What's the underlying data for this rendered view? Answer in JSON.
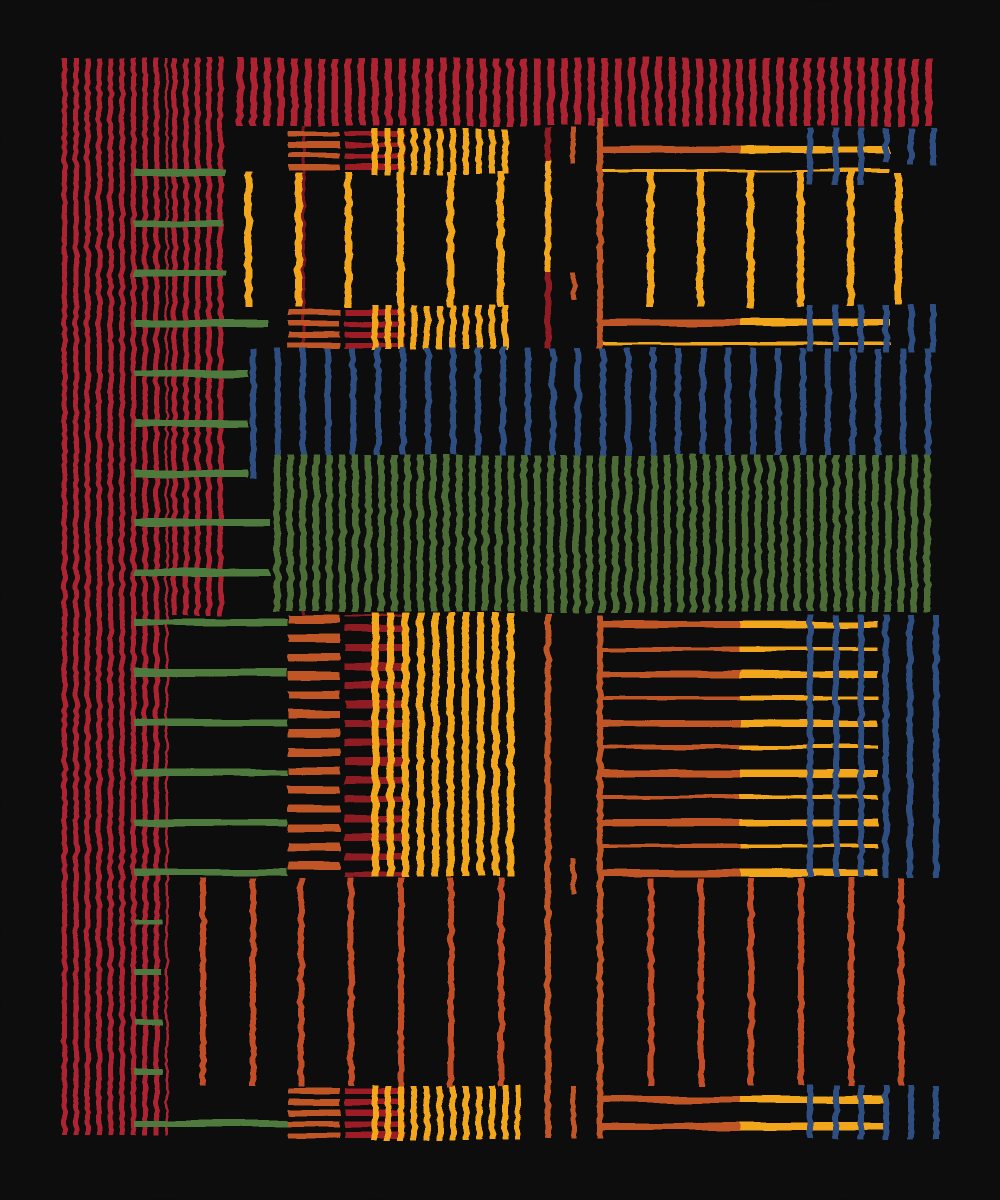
{
  "canvas": {
    "w": 1000,
    "h": 1200,
    "bg": "#0d0b08"
  },
  "palette": {
    "bg": "#0d0b08",
    "red": "#ae2130",
    "darkred": "#8e1b24",
    "darkred2": "#9e1c27",
    "orange": "#c05428",
    "rust": "#c24e26",
    "yellow": "#f2a61b",
    "green": "#4c6c36",
    "green2": "#4f7a3e",
    "blue": "#2d4e80",
    "redline": "#7a1620"
  },
  "blocks": [
    {
      "n": "left-red-column-main",
      "t": "v",
      "x": 62,
      "y": 58,
      "w": 106,
      "h": 1077,
      "c": "red",
      "p": 11.5,
      "s": 5
    },
    {
      "n": "left-red-column-secondary",
      "t": "v",
      "x": 172,
      "y": 58,
      "w": 57,
      "h": 557,
      "c": "red",
      "p": 11.5,
      "s": 5
    },
    {
      "n": "top-red-band",
      "t": "v",
      "x": 237,
      "y": 58,
      "w": 698,
      "h": 68,
      "c": "red",
      "p": 13.5,
      "s": 6.5
    },
    {
      "n": "thin-red-connector",
      "t": "r",
      "x": 302,
      "y": 126,
      "w": 3,
      "h": 489,
      "c": "redline"
    },
    {
      "n": "band1-orange-hstripes",
      "t": "h",
      "x": 288,
      "y": 131,
      "w": 52,
      "h": 41,
      "c": "orange",
      "p": 11,
      "s": 5.5
    },
    {
      "n": "band1-red-hstripes",
      "t": "h",
      "x": 345,
      "y": 131,
      "w": 60,
      "h": 41,
      "c": "darkred2",
      "p": 11,
      "s": 5.5
    },
    {
      "n": "band1-yellow-vstripes",
      "t": "v",
      "x": 372,
      "y": 128,
      "w": 143,
      "h": 47,
      "c": "yellow",
      "p": 13,
      "s": 6
    },
    {
      "n": "band2-orange-hstripes",
      "t": "h",
      "x": 288,
      "y": 310,
      "w": 52,
      "h": 38,
      "c": "orange",
      "p": 11,
      "s": 5.5
    },
    {
      "n": "band2-red-hstripes",
      "t": "h",
      "x": 345,
      "y": 310,
      "w": 60,
      "h": 38,
      "c": "darkred2",
      "p": 11,
      "s": 5.5
    },
    {
      "n": "band2-yellow-vstripes",
      "t": "v",
      "x": 372,
      "y": 305,
      "w": 143,
      "h": 45,
      "c": "yellow",
      "p": 13,
      "s": 6
    },
    {
      "n": "blue-stripe-band",
      "t": "v",
      "x": 250,
      "y": 348,
      "w": 682,
      "h": 107,
      "c": "blue",
      "p": 25,
      "s": 6
    },
    {
      "n": "blue-band-first-line",
      "t": "r",
      "x": 250,
      "y": 348,
      "w": 6,
      "h": 130,
      "c": "blue"
    },
    {
      "n": "green-stripe-block",
      "t": "v",
      "x": 274,
      "y": 455,
      "w": 659,
      "h": 157,
      "c": "green",
      "p": 13,
      "s": 6.5
    },
    {
      "n": "midleft-orange-hstripes",
      "t": "h",
      "x": 288,
      "y": 615,
      "w": 52,
      "h": 262,
      "c": "orange",
      "p": 19,
      "s": 8
    },
    {
      "n": "midleft-red-hstripes",
      "t": "h",
      "x": 345,
      "y": 615,
      "w": 27,
      "h": 262,
      "c": "darkred",
      "p": 19,
      "s": 7,
      "o": 10
    },
    {
      "n": "midleft-plaid-red-hstripes",
      "t": "h",
      "x": 372,
      "y": 615,
      "w": 33,
      "h": 262,
      "c": "darkred",
      "p": 19,
      "s": 7,
      "o": 10
    },
    {
      "n": "midleft-yellow-vstripes",
      "t": "v",
      "x": 372,
      "y": 613,
      "w": 148,
      "h": 264,
      "c": "yellow",
      "p": 15,
      "s": 7
    },
    {
      "n": "bottomband-orange-hstripes",
      "t": "h",
      "x": 288,
      "y": 1088,
      "w": 52,
      "h": 50,
      "c": "orange",
      "p": 11,
      "s": 6
    },
    {
      "n": "bottomband-red-hstripes",
      "t": "h",
      "x": 345,
      "y": 1088,
      "w": 60,
      "h": 50,
      "c": "darkred2",
      "p": 11,
      "s": 6
    },
    {
      "n": "bottomband-yellow-vstripes",
      "t": "v",
      "x": 372,
      "y": 1085,
      "w": 148,
      "h": 55,
      "c": "yellow",
      "p": 13,
      "s": 6
    }
  ],
  "combs": [
    {
      "n": "band1-comb",
      "ox": 597,
      "ow": 143,
      "yx": 740,
      "yw": 150,
      "rows": [
        [
          146,
          7
        ]
      ],
      "thin": [
        169,
        3
      ]
    },
    {
      "n": "band2-comb",
      "ox": 597,
      "ow": 143,
      "yx": 740,
      "yw": 150,
      "rows": [
        [
          319,
          7
        ]
      ],
      "thin": [
        342,
        3
      ]
    },
    {
      "n": "midright-comb",
      "ox": 597,
      "ow": 143,
      "yx": 740,
      "yw": 138,
      "rows": [
        [
          621,
          7
        ],
        [
          647,
          4
        ],
        [
          671,
          7
        ],
        [
          696,
          4
        ],
        [
          720,
          7
        ],
        [
          745,
          4
        ],
        [
          770,
          7
        ],
        [
          795,
          4
        ],
        [
          819,
          7
        ],
        [
          844,
          4
        ],
        [
          869,
          8
        ]
      ]
    },
    {
      "n": "bottomband-comb",
      "ox": 597,
      "ow": 143,
      "yx": 740,
      "yw": 148,
      "rows": [
        [
          1096,
          7
        ],
        [
          1123,
          7
        ]
      ]
    }
  ],
  "segments": [
    {
      "n": "green-tick",
      "t": "r",
      "x": 134,
      "y": 169,
      "w": 92,
      "h": 7,
      "c": "green2"
    },
    {
      "n": "green-tick",
      "t": "r",
      "x": 134,
      "y": 220,
      "w": 88,
      "h": 7,
      "c": "green2"
    },
    {
      "n": "green-tick",
      "t": "r",
      "x": 134,
      "y": 270,
      "w": 92,
      "h": 7,
      "c": "green2"
    },
    {
      "n": "green-tick",
      "t": "r",
      "x": 134,
      "y": 320,
      "w": 134,
      "h": 7,
      "c": "green2"
    },
    {
      "n": "green-tick",
      "t": "r",
      "x": 134,
      "y": 370,
      "w": 114,
      "h": 7,
      "c": "green2"
    },
    {
      "n": "green-tick",
      "t": "r",
      "x": 134,
      "y": 420,
      "w": 114,
      "h": 7,
      "c": "green2"
    },
    {
      "n": "green-tick",
      "t": "r",
      "x": 134,
      "y": 470,
      "w": 114,
      "h": 7,
      "c": "green2"
    },
    {
      "n": "green-tick",
      "t": "r",
      "x": 134,
      "y": 519,
      "w": 136,
      "h": 7,
      "c": "green2"
    },
    {
      "n": "green-tick",
      "t": "r",
      "x": 134,
      "y": 569,
      "w": 136,
      "h": 7,
      "c": "green2"
    },
    {
      "n": "green-tick",
      "t": "r",
      "x": 134,
      "y": 619,
      "w": 153,
      "h": 7,
      "c": "green2"
    },
    {
      "n": "green-tick",
      "t": "r",
      "x": 134,
      "y": 669,
      "w": 153,
      "h": 7,
      "c": "green2"
    },
    {
      "n": "green-tick",
      "t": "r",
      "x": 134,
      "y": 719,
      "w": 153,
      "h": 7,
      "c": "green2"
    },
    {
      "n": "green-tick",
      "t": "r",
      "x": 134,
      "y": 769,
      "w": 153,
      "h": 7,
      "c": "green2"
    },
    {
      "n": "green-tick",
      "t": "r",
      "x": 134,
      "y": 819,
      "w": 153,
      "h": 7,
      "c": "green2"
    },
    {
      "n": "green-tick",
      "t": "r",
      "x": 134,
      "y": 869,
      "w": 153,
      "h": 7,
      "c": "green2"
    },
    {
      "n": "green-tick",
      "t": "r",
      "x": 134,
      "y": 919,
      "w": 28,
      "h": 6,
      "c": "green2"
    },
    {
      "n": "green-tick",
      "t": "r",
      "x": 134,
      "y": 969,
      "w": 28,
      "h": 6,
      "c": "green2"
    },
    {
      "n": "green-tick",
      "t": "r",
      "x": 134,
      "y": 1019,
      "w": 28,
      "h": 6,
      "c": "green2"
    },
    {
      "n": "green-tick",
      "t": "r",
      "x": 134,
      "y": 1069,
      "w": 28,
      "h": 6,
      "c": "green2"
    },
    {
      "n": "green-tick",
      "t": "r",
      "x": 134,
      "y": 1120,
      "w": 154,
      "h": 7,
      "c": "green2"
    },
    {
      "n": "yellow-vline",
      "t": "r",
      "x": 245,
      "y": 172,
      "w": 7,
      "h": 135,
      "c": "yellow"
    },
    {
      "n": "yellow-vline",
      "t": "r",
      "x": 295,
      "y": 172,
      "w": 7,
      "h": 135,
      "c": "yellow"
    },
    {
      "n": "yellow-vline",
      "t": "r",
      "x": 345,
      "y": 172,
      "w": 7,
      "h": 135,
      "c": "yellow"
    },
    {
      "n": "yellow-vline",
      "t": "r",
      "x": 397,
      "y": 172,
      "w": 7,
      "h": 135,
      "c": "yellow"
    },
    {
      "n": "yellow-vline",
      "t": "r",
      "x": 447,
      "y": 172,
      "w": 7,
      "h": 135,
      "c": "yellow"
    },
    {
      "n": "yellow-vline",
      "t": "r",
      "x": 497,
      "y": 172,
      "w": 7,
      "h": 135,
      "c": "yellow"
    },
    {
      "n": "yellow-vline",
      "t": "r",
      "x": 647,
      "y": 172,
      "w": 7,
      "h": 135,
      "c": "yellow"
    },
    {
      "n": "yellow-vline",
      "t": "r",
      "x": 697,
      "y": 172,
      "w": 7,
      "h": 135,
      "c": "yellow"
    },
    {
      "n": "yellow-vline",
      "t": "r",
      "x": 747,
      "y": 172,
      "w": 7,
      "h": 135,
      "c": "yellow"
    },
    {
      "n": "yellow-vline",
      "t": "r",
      "x": 797,
      "y": 172,
      "w": 7,
      "h": 135,
      "c": "yellow"
    },
    {
      "n": "yellow-vline",
      "t": "r",
      "x": 847,
      "y": 172,
      "w": 7,
      "h": 135,
      "c": "yellow"
    },
    {
      "n": "yellow-vline",
      "t": "r",
      "x": 895,
      "y": 172,
      "w": 7,
      "h": 133,
      "c": "yellow"
    },
    {
      "n": "center-line-a",
      "t": "r",
      "x": 545,
      "y": 128,
      "w": 6,
      "h": 34,
      "c": "darkred"
    },
    {
      "n": "center-line-a",
      "t": "r",
      "x": 545,
      "y": 160,
      "w": 6,
      "h": 114,
      "c": "yellow"
    },
    {
      "n": "center-line-a",
      "t": "r",
      "x": 545,
      "y": 272,
      "w": 6,
      "h": 76,
      "c": "darkred"
    },
    {
      "n": "center-line-a",
      "t": "r",
      "x": 545,
      "y": 613,
      "w": 6,
      "h": 525,
      "c": "orange"
    },
    {
      "n": "center-line-b",
      "t": "r",
      "x": 571,
      "y": 128,
      "w": 5,
      "h": 36,
      "c": "orange"
    },
    {
      "n": "center-line-b",
      "t": "r",
      "x": 571,
      "y": 272,
      "w": 5,
      "h": 28,
      "c": "orange"
    },
    {
      "n": "center-line-b",
      "t": "r",
      "x": 571,
      "y": 858,
      "w": 5,
      "h": 37,
      "c": "orange"
    },
    {
      "n": "center-line-b",
      "t": "r",
      "x": 571,
      "y": 1085,
      "w": 5,
      "h": 53,
      "c": "orange"
    },
    {
      "n": "center-line-c",
      "t": "r",
      "x": 597,
      "y": 118,
      "w": 6,
      "h": 230,
      "c": "orange"
    },
    {
      "n": "center-line-c",
      "t": "r",
      "x": 597,
      "y": 615,
      "w": 6,
      "h": 523,
      "c": "orange"
    },
    {
      "n": "rust-vline",
      "t": "r",
      "x": 200,
      "y": 878,
      "w": 6,
      "h": 208,
      "c": "rust"
    },
    {
      "n": "rust-vline",
      "t": "r",
      "x": 250,
      "y": 878,
      "w": 6,
      "h": 208,
      "c": "rust"
    },
    {
      "n": "rust-vline",
      "t": "r",
      "x": 298,
      "y": 878,
      "w": 6,
      "h": 208,
      "c": "rust"
    },
    {
      "n": "rust-vline",
      "t": "r",
      "x": 348,
      "y": 878,
      "w": 6,
      "h": 208,
      "c": "rust"
    },
    {
      "n": "rust-vline",
      "t": "r",
      "x": 398,
      "y": 878,
      "w": 6,
      "h": 208,
      "c": "rust"
    },
    {
      "n": "rust-vline",
      "t": "r",
      "x": 448,
      "y": 878,
      "w": 6,
      "h": 208,
      "c": "rust"
    },
    {
      "n": "rust-vline",
      "t": "r",
      "x": 498,
      "y": 878,
      "w": 6,
      "h": 208,
      "c": "rust"
    },
    {
      "n": "rust-vline",
      "t": "r",
      "x": 648,
      "y": 878,
      "w": 6,
      "h": 208,
      "c": "rust"
    },
    {
      "n": "rust-vline",
      "t": "r",
      "x": 698,
      "y": 878,
      "w": 6,
      "h": 208,
      "c": "rust"
    },
    {
      "n": "rust-vline",
      "t": "r",
      "x": 748,
      "y": 878,
      "w": 6,
      "h": 208,
      "c": "rust"
    },
    {
      "n": "rust-vline",
      "t": "r",
      "x": 798,
      "y": 878,
      "w": 6,
      "h": 208,
      "c": "rust"
    },
    {
      "n": "rust-vline",
      "t": "r",
      "x": 848,
      "y": 878,
      "w": 6,
      "h": 208,
      "c": "rust"
    },
    {
      "n": "rust-vline",
      "t": "r",
      "x": 898,
      "y": 878,
      "w": 6,
      "h": 208,
      "c": "rust"
    },
    {
      "n": "blue-dash",
      "t": "r",
      "x": 807,
      "y": 128,
      "w": 6,
      "h": 56,
      "c": "blue"
    },
    {
      "n": "blue-dash",
      "t": "r",
      "x": 833,
      "y": 128,
      "w": 6,
      "h": 56,
      "c": "blue"
    },
    {
      "n": "blue-dash",
      "t": "r",
      "x": 858,
      "y": 128,
      "w": 6,
      "h": 56,
      "c": "blue"
    },
    {
      "n": "blue-dash",
      "t": "r",
      "x": 883,
      "y": 128,
      "w": 6,
      "h": 34,
      "c": "blue"
    },
    {
      "n": "blue-dash",
      "t": "r",
      "x": 908,
      "y": 128,
      "w": 6,
      "h": 36,
      "c": "blue"
    },
    {
      "n": "blue-dash",
      "t": "r",
      "x": 930,
      "y": 128,
      "w": 6,
      "h": 38,
      "c": "blue"
    },
    {
      "n": "blue-dash",
      "t": "r",
      "x": 807,
      "y": 305,
      "w": 6,
      "h": 47,
      "c": "blue"
    },
    {
      "n": "blue-dash",
      "t": "r",
      "x": 833,
      "y": 305,
      "w": 6,
      "h": 47,
      "c": "blue"
    },
    {
      "n": "blue-dash",
      "t": "r",
      "x": 858,
      "y": 305,
      "w": 6,
      "h": 47,
      "c": "blue"
    },
    {
      "n": "blue-dash",
      "t": "r",
      "x": 883,
      "y": 305,
      "w": 6,
      "h": 47,
      "c": "blue"
    },
    {
      "n": "blue-dash",
      "t": "r",
      "x": 908,
      "y": 305,
      "w": 6,
      "h": 47,
      "c": "blue"
    },
    {
      "n": "blue-dash",
      "t": "r",
      "x": 930,
      "y": 305,
      "w": 6,
      "h": 47,
      "c": "blue"
    },
    {
      "n": "blue-vline",
      "t": "r",
      "x": 807,
      "y": 615,
      "w": 6,
      "h": 263,
      "c": "blue"
    },
    {
      "n": "blue-vline",
      "t": "r",
      "x": 833,
      "y": 615,
      "w": 6,
      "h": 263,
      "c": "blue"
    },
    {
      "n": "blue-vline",
      "t": "r",
      "x": 858,
      "y": 615,
      "w": 6,
      "h": 263,
      "c": "blue"
    },
    {
      "n": "blue-vline",
      "t": "r",
      "x": 883,
      "y": 615,
      "w": 6,
      "h": 263,
      "c": "blue"
    },
    {
      "n": "blue-vline",
      "t": "r",
      "x": 907,
      "y": 615,
      "w": 6,
      "h": 263,
      "c": "blue"
    },
    {
      "n": "blue-vline",
      "t": "r",
      "x": 933,
      "y": 615,
      "w": 6,
      "h": 263,
      "c": "blue"
    },
    {
      "n": "blue-dash",
      "t": "r",
      "x": 807,
      "y": 1085,
      "w": 6,
      "h": 54,
      "c": "blue"
    },
    {
      "n": "blue-dash",
      "t": "r",
      "x": 833,
      "y": 1085,
      "w": 6,
      "h": 54,
      "c": "blue"
    },
    {
      "n": "blue-dash",
      "t": "r",
      "x": 858,
      "y": 1085,
      "w": 6,
      "h": 54,
      "c": "blue"
    },
    {
      "n": "blue-dash",
      "t": "r",
      "x": 883,
      "y": 1085,
      "w": 6,
      "h": 54,
      "c": "blue"
    },
    {
      "n": "blue-dash",
      "t": "r",
      "x": 908,
      "y": 1085,
      "w": 6,
      "h": 54,
      "c": "blue"
    },
    {
      "n": "blue-dash",
      "t": "r",
      "x": 933,
      "y": 1085,
      "w": 6,
      "h": 54,
      "c": "blue"
    }
  ]
}
